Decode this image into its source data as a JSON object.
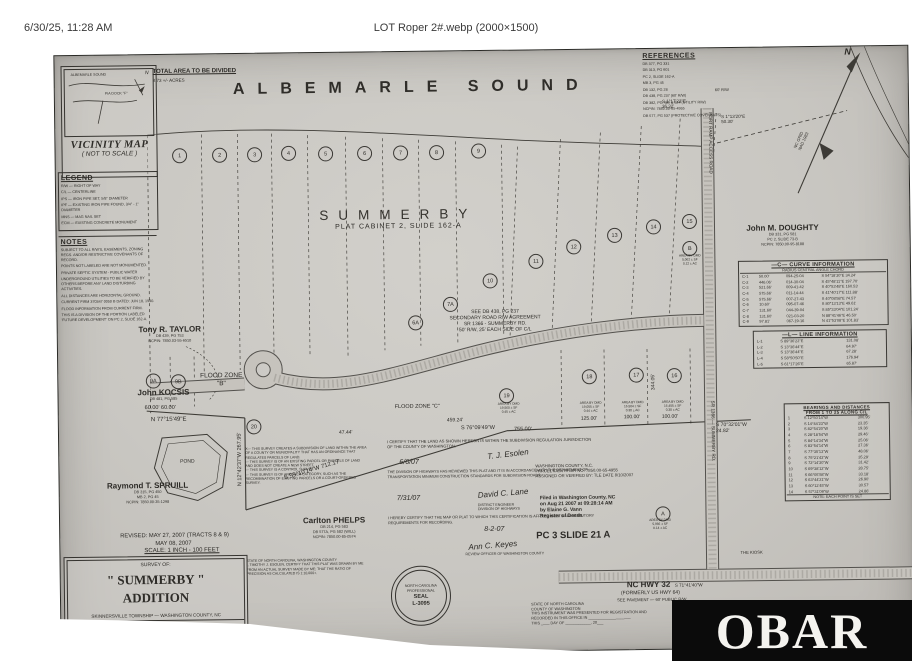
{
  "header": {
    "datetime": "6/30/25, 11:28 AM",
    "filename": "LOT Roper 2#.webp (2000×1500)"
  },
  "watermark": {
    "text": "OBAR",
    "bg": "#0b0b0b",
    "fg": "#f4f3ef"
  },
  "plat": {
    "sound_title": "ALBEMARLE  SOUND",
    "summerby": "SUMMERBY",
    "plat_ref": "PLAT CABINET 2, SLIDE 162-A",
    "total_area": {
      "title": "TOTAL AREA TO BE DIVIDED",
      "value": "8.73 +/- ACRES"
    },
    "vicinity": {
      "title": "VICINITY MAP",
      "sub": "( NOT TO SCALE )",
      "inset_sound": "ALBEMARLE SOUND",
      "inset_road": "PIA DOCK \"F\"",
      "inset_n": "N"
    },
    "legend": {
      "title": "LEGEND",
      "items": [
        "R/W — RIGHT OF WAY",
        "C/L — CENTERLINE",
        "IPS — IRON PIPE SET, 5/8\" DIAMETER",
        "IPF — EXISTING IRON PIPE FOUND, 3/4\" - 1\" DIAMETER",
        "MNS — MAG NAIL SET",
        "ECM — EXISTING CONCRETE MONUMENT"
      ]
    },
    "notes": {
      "title": "NOTES",
      "items": [
        "SUBJECT TO ALL R/W'S, EASEMENTS, ZONING REGS. AND/OR RESTRICTIVE COVENANTS OF RECORD.",
        "POINTS NOT LABELED ARE NOT MONUMENTED.",
        "PRIVATE SEPTIC SYSTEM - PUBLIC WATER",
        "UNDERGROUND UTILITIES TO BE VERIFIED BY OTHERS BEFORE ANY LAND DISTURBING ACTIVITIES.",
        "ALL DISTANCES ARE HORIZONTAL GROUND.",
        "CURRENT FIRM 370347 0050 B DATED: JUN 18, 1990.",
        "FLOOD INFORMATION FROM CURRENT FIRM.",
        "THIS IS A DIVISION OF THE PORTION LABELED 'FUTURE DEVELOPMENT' ON PC 2, SLIDE 162-A."
      ]
    },
    "references": {
      "title": "REFERENCES",
      "items": [
        "DB 377, PG 331",
        "DB 313, PG 601",
        "PC 2, SLIDE 162-A",
        "MB 3, PG 45",
        "DB 132, PG 28",
        "DB 438, PG 237 (60' R/W)",
        "DB 382, PG 489 & 624 (UTILITY R/W)",
        "NCPIN: 7850.00-65-4955",
        "DB 577, PG 537 (PROTECTIVE COVENANTS)"
      ]
    },
    "owners": [
      {
        "name": "Tony R. TAYLOR",
        "details": "DB 439, PG 753\nNCPIN: 7850.03-55-6510",
        "x": 62,
        "y": 270,
        "w": 100
      },
      {
        "name": "John KOCSIS",
        "details": "DB 481, PG 585",
        "x": 55,
        "y": 333,
        "w": 100
      },
      {
        "name": "Raymond T. SPRUILL",
        "details": "DB 315, PG 450\nMB 2, PG 45\nNCPIN: 7850.00-35-1298",
        "x": 38,
        "y": 426,
        "w": 100
      },
      {
        "name": "Carlton PHELPS",
        "details": "DB 214, PG 583\nDB 577A, PG 582 (WILL)\nNCPIN: 7850.00-85-0574",
        "x": 224,
        "y": 463,
        "w": 100
      },
      {
        "name": "John M. DOUGHTY",
        "details": "DB 331, PG 581\nPC 2, SLIDE 73-B\nNCPIN: 7850.00-95-8188",
        "x": 676,
        "y": 176,
        "w": 100
      }
    ],
    "lots": [
      {
        "n": "1",
        "x": 124,
        "y": 101
      },
      {
        "n": "2",
        "x": 164,
        "y": 101
      },
      {
        "n": "3",
        "x": 199,
        "y": 101
      },
      {
        "n": "4",
        "x": 233,
        "y": 100
      },
      {
        "n": "5",
        "x": 270,
        "y": 101
      },
      {
        "n": "6",
        "x": 309,
        "y": 101
      },
      {
        "n": "7",
        "x": 345,
        "y": 101
      },
      {
        "n": "8",
        "x": 381,
        "y": 101
      },
      {
        "n": "9",
        "x": 423,
        "y": 100
      },
      {
        "n": "10",
        "x": 433,
        "y": 230
      },
      {
        "n": "11",
        "x": 479,
        "y": 211
      },
      {
        "n": "12",
        "x": 517,
        "y": 197
      },
      {
        "n": "13",
        "x": 558,
        "y": 186
      },
      {
        "n": "14",
        "x": 597,
        "y": 178
      },
      {
        "n": "15",
        "x": 633,
        "y": 173
      },
      {
        "n": "B",
        "x": 633,
        "y": 200
      },
      {
        "n": "7A",
        "x": 393,
        "y": 253
      },
      {
        "n": "6A",
        "x": 358,
        "y": 271
      },
      {
        "n": "9A",
        "x": 95,
        "y": 326
      },
      {
        "n": "9B",
        "x": 120,
        "y": 327
      },
      {
        "n": "20",
        "x": 195,
        "y": 373
      },
      {
        "n": "19",
        "x": 448,
        "y": 345
      },
      {
        "n": "18",
        "x": 531,
        "y": 327
      },
      {
        "n": "17",
        "x": 578,
        "y": 326
      },
      {
        "n": "16",
        "x": 616,
        "y": 327
      },
      {
        "n": "A",
        "x": 603,
        "y": 465
      }
    ],
    "curve_table": {
      "title": "—C— CURVE INFORMATION",
      "colhead": "RADIUS      CENTRAL ANGLE      CHORD",
      "rows": [
        {
          "id": "C-1",
          "r": "50.00'",
          "a": "094-25-04",
          "c": "S 54°18'30\"E  34.24'"
        },
        {
          "id": "C-2",
          "r": "446.06'",
          "a": "014-30-04",
          "c": "S 45°48'11\"E  197.70'"
        },
        {
          "id": "C-3",
          "r": "521.66'",
          "a": "009-41-42",
          "c": "S 40°53'48\"E  160.53'"
        },
        {
          "id": "C-4",
          "r": "575.66'",
          "a": "011-14-44",
          "c": "S 41°40'17\"E  111.88'"
        },
        {
          "id": "C-5",
          "r": "575.66'",
          "a": "007-27-43",
          "c": "S 40°08'58\"E  74.57'"
        },
        {
          "id": "C-6",
          "r": "10.60'",
          "a": "095-07-46",
          "c": "S 80°13'13\"E  49.61'"
        },
        {
          "id": "C-7",
          "r": "131.60'",
          "a": "044-39-04",
          "c": "S 85°33'04\"E  101.24'"
        },
        {
          "id": "C-8",
          "r": "131.60'",
          "a": "021-03-20",
          "c": "N 88°41'46\"E  46.50'"
        },
        {
          "id": "C-9",
          "r": "97.81'",
          "a": "067-19-16",
          "c": "N 41°53'08\"E  101.83'"
        }
      ]
    },
    "line_table": {
      "title": "—L— LINE INFORMATION",
      "rows": [
        {
          "id": "L-1",
          "b": "S 89°36'22\"E",
          "d": "131.08'"
        },
        {
          "id": "L-2",
          "b": "S 13°36'44\"E",
          "d": "64.97'"
        },
        {
          "id": "L-3",
          "b": "S 13°36'44\"E",
          "d": "67.28'"
        },
        {
          "id": "L-4",
          "b": "S 58°50'50\"E",
          "d": "176.94'"
        },
        {
          "id": "L-5",
          "b": "S 61°17'26\"E",
          "d": "65.87'"
        }
      ]
    },
    "cl_table": {
      "title": "BEARINGS AND DISTANCES\nFROM 1 TO 25 ALONG C/L",
      "note": "NOTE: EACH POINT IS SET",
      "rows": [
        {
          "id": "1",
          "b": "S 12°50'14\"W",
          "d": "300.95'"
        },
        {
          "id": "2",
          "b": "S 14°44'23\"W",
          "d": "23.35'"
        },
        {
          "id": "3",
          "b": "S 82°54'20\"W",
          "d": "19.36'"
        },
        {
          "id": "4",
          "b": "S 28°18'54\"W",
          "d": "29.46'"
        },
        {
          "id": "5",
          "b": "S 84°14'34\"W",
          "d": "25.06'"
        },
        {
          "id": "6",
          "b": "S 83°54'14\"W",
          "d": "27.36'"
        },
        {
          "id": "7",
          "b": "S 77°35'13\"W",
          "d": "48.06'"
        },
        {
          "id": "8",
          "b": "S 75°21'43\"W",
          "d": "35.29'"
        },
        {
          "id": "9",
          "b": "S 72°14'30\"W",
          "d": "31.42'"
        },
        {
          "id": "10",
          "b": "S 69°38'12\"W",
          "d": "28.75'"
        },
        {
          "id": "11",
          "b": "S 66°05'58\"W",
          "d": "33.18'"
        },
        {
          "id": "12",
          "b": "S 63°44'21\"W",
          "d": "26.90'"
        },
        {
          "id": "13",
          "b": "S 60°12'45\"W",
          "d": "30.57'"
        },
        {
          "id": "14",
          "b": "S 57°31'09\"W",
          "d": "24.86'"
        }
      ]
    },
    "title_block": {
      "survey_of": "SURVEY OF:",
      "name": "\" SUMMERBY \"",
      "name2": "ADDITION",
      "township": "SKINNERSVILLE TOWNSHIP — WASHINGTON COUNTY, NC",
      "surveyor": "TIMOTHY J. ESOLEN",
      "license": "PROFESSIONAL LAND SURVEYOR L-3095"
    },
    "seal": {
      "l1": "NORTH CAROLINA",
      "l2": "PROFESSIONAL",
      "l3": "SEAL",
      "l4": "L-3095"
    },
    "annotations": [
      {
        "t": "60.00'   60.00'",
        "x": 86,
        "y": 350,
        "s": 5.5
      },
      {
        "t": "N 77°15'49\"E",
        "x": 92,
        "y": 362,
        "s": 6
      },
      {
        "t": "N 12°42'37\"W   267.95'",
        "x": 136,
        "y": 402,
        "s": 5.5,
        "rot": -90,
        "w": 90,
        "align": "center"
      },
      {
        "t": "S 55°10'14\"W      712.17'",
        "x": 188,
        "y": 414,
        "s": 6,
        "rot": -16,
        "w": 130,
        "align": "center"
      },
      {
        "t": "S 76°09'49\"W",
        "x": 402,
        "y": 374,
        "s": 5.5
      },
      {
        "t": "755.00'",
        "x": 455,
        "y": 376,
        "s": 5.5
      },
      {
        "t": "459.24'",
        "x": 388,
        "y": 366,
        "s": 5
      },
      {
        "t": "47.44'",
        "x": 280,
        "y": 377,
        "s": 5
      },
      {
        "t": "125.00'",
        "x": 522,
        "y": 366,
        "s": 5
      },
      {
        "t": "100.00'",
        "x": 565,
        "y": 365,
        "s": 5
      },
      {
        "t": "100.00'",
        "x": 603,
        "y": 365,
        "s": 5
      },
      {
        "t": "S 70°32'01\"W\n24.82'",
        "x": 657,
        "y": 374,
        "s": 5
      },
      {
        "t": "S 1°17'23\"E\n36.32'",
        "x": 607,
        "y": 50,
        "s": 4.5
      },
      {
        "t": "S 1°13'20\"E\n50.30'",
        "x": 666,
        "y": 66,
        "s": 4.5
      },
      {
        "t": "344.05'",
        "x": 563,
        "y": 330,
        "s": 5,
        "rot": -90,
        "w": 64,
        "align": "center"
      },
      {
        "t": "FLOOD ZONE\n\"B\"",
        "x": 132,
        "y": 318,
        "s": 6.5,
        "w": 62,
        "align": "center"
      },
      {
        "t": "FLOOD ZONE \"C\"",
        "x": 336,
        "y": 352,
        "s": 5.5
      },
      {
        "t": "POND",
        "x": 108,
        "y": 404,
        "s": 5,
        "w": 40,
        "align": "center"
      },
      {
        "t": "NC GRID\nNAD 1983",
        "x": 736,
        "y": 88,
        "s": 4.2,
        "rot": -65
      },
      {
        "t": "60' R/W",
        "x": 660,
        "y": 40,
        "s": 4
      },
      {
        "t": "THE KIOSK",
        "x": 680,
        "y": 502,
        "s": 4.2
      },
      {
        "t": "S 71°41'40\"W",
        "x": 614,
        "y": 534,
        "s": 4.5
      },
      {
        "t": "NC HWY 32",
        "x": 566,
        "y": 531,
        "s": 8,
        "bold": true,
        "name": "nc-hwy-32-label"
      },
      {
        "t": "(FORMERLY US HWY 64)",
        "x": 560,
        "y": 541,
        "s": 5
      },
      {
        "t": "SEE PAVEMENT — 60' PUBLIC R/W",
        "x": 556,
        "y": 548,
        "s": 4.2
      },
      {
        "t": "REVISED:  MAY 27, 2007 (TRACTS 8 & 9)",
        "x": 60,
        "y": 478,
        "s": 5.8,
        "name": "revised-date"
      },
      {
        "t": "MAY 08, 2007",
        "x": 95,
        "y": 486,
        "s": 5.8,
        "name": "survey-date"
      },
      {
        "t": "SCALE:  1 INCH - 100 FEET",
        "x": 84,
        "y": 493,
        "s": 6,
        "u": true,
        "name": "scale-label"
      },
      {
        "t": "N",
        "x": 790,
        "y": 0,
        "s": 9,
        "bold": true,
        "italic": true,
        "name": "north-label"
      },
      {
        "t": "6/6/07",
        "x": 340,
        "y": 407,
        "s": 7,
        "italic": true
      },
      {
        "t": "7/31/07",
        "x": 337,
        "y": 443,
        "s": 7,
        "italic": true
      },
      {
        "t": "8-2-07",
        "x": 424,
        "y": 475,
        "s": 7,
        "italic": true
      },
      {
        "t": "T. J. Esolen",
        "x": 428,
        "y": 399,
        "s": 8,
        "italic": true,
        "rot": -6,
        "name": "signature"
      },
      {
        "t": "David C. Lane",
        "x": 418,
        "y": 438,
        "s": 8,
        "italic": true,
        "rot": -4,
        "name": "signature"
      },
      {
        "t": "Ann C. Keyes",
        "x": 408,
        "y": 490,
        "s": 8,
        "italic": true,
        "rot": -4,
        "name": "signature"
      },
      {
        "t": "DISTRICT ENGINEER\nDIVISION OF HIGHWAYS",
        "x": 418,
        "y": 452,
        "s": 3.6
      },
      {
        "t": "REVIEW OFFICER OF WASHINGTON COUNTY",
        "x": 405,
        "y": 501,
        "s": 3.6
      },
      {
        "t": "I CERTIFY THAT THE LAND AS SHOWN HEREON IS WITHIN THE SUBDIVISION REGULATION JURISDICTION OF THE COUNTY OF WASHINGTON.",
        "x": 328,
        "y": 388,
        "s": 4,
        "w": 205
      },
      {
        "t": "THE DIVISION OF HIGHWAYS HAS REVIEWED THIS PLAT AND IT IS IN ACCORDANCE WITH THE DEPARTMENT OF TRANSPORTATION MINIMUM CONSTRUCTION STANDARDS FOR SUBDIVISION ROADS.",
        "x": 328,
        "y": 418,
        "s": 3.7,
        "w": 210
      },
      {
        "t": "I HEREBY CERTIFY THAT THE MAP OR PLAT TO WHICH THIS CERTIFICATION IS AFFIXED MEETS ALL STATUTORY REQUIREMENTS FOR RECORDING.",
        "x": 328,
        "y": 464,
        "s": 3.8,
        "w": 210
      },
      {
        "t": "X— THIS SURVEY CREATES A SUBDIVISION OF LAND WITHIN THE AREA OF A COUNTY OR MUNICIPALITY THAT HAS AN ORDINANCE THAT REGULATES PARCELS OF LAND.\n— THIS SURVEY IS OF AN EXISTING PARCEL OR PARCELS OF LAND AND DOES NOT CREATE A NEW STREET.\n— THIS SURVEY IS A CONTROL SURVEY.\n— THIS SURVEY IS OF ANOTHER CATEGORY, SUCH AS THE RECOMBINATION OF EXISTING PARCELS OR A COURT-ORDERED SURVEY.",
        "x": 186,
        "y": 393,
        "s": 3.5,
        "w": 122
      },
      {
        "t": "STATE OF NORTH CAROLINA, WASHINGTON COUNTY\nI, TIMOTHY J. ESOLEN, CERTIFY THAT THIS PLAT WAS DRAWN BY ME FROM AN ACTUAL SURVEY MADE BY ME; THAT THE RATIO OF PRECISION AS CALCULATED IS 1:10,000+.",
        "x": 186,
        "y": 505,
        "s": 3.5,
        "w": 122
      },
      {
        "t": "SEE DB 438, PG 237\nSECONDARY ROAD R/W AGREEMENT\nSR 1366 - SUMMERBY RD.\n50' R/W, 25' EACH SIDE OF C/L",
        "x": 340,
        "y": 258,
        "s": 5,
        "w": 195,
        "align": "center",
        "name": "road-agreement-note"
      },
      {
        "t": "PORT RAMP ACCESS ROAD",
        "x": 600,
        "y": 92,
        "s": 4.6,
        "rot": 90,
        "w": 110,
        "align": "center",
        "name": "port-ramp-road-label"
      },
      {
        "t": "SR 1366 — SUMMERBY RD.",
        "x": 598,
        "y": 380,
        "s": 4.6,
        "rot": 90,
        "w": 112,
        "align": "center",
        "name": "summerby-road-label"
      },
      {
        "t": "WASHINGTON COUNTY, N.C.\nPARCEL IDENTIFIER NO.  7850.00-65-4955\nASSIGNED OR VERIFIED BY:  TLE     DATE 8/10/2007",
        "x": 476,
        "y": 413,
        "s": 4.2,
        "name": "parcel-identifier-block"
      },
      {
        "t": "Filed in Washington County, NC\non Aug 21 2007 at 09:28:14 AM\nby   Elaine G. Vann\n      Register of Deeds",
        "x": 480,
        "y": 445,
        "s": 5,
        "bold": true,
        "name": "filed-stamp"
      },
      {
        "t": "PC 3 SLIDE 21 A",
        "x": 476,
        "y": 480,
        "s": 9.5,
        "bold": true,
        "name": "pc-slide-label"
      },
      {
        "t": "STATE OF NORTH CAROLINA\nCOUNTY OF  WASHINGTON\nTHIS INSTRUMENT WAS PRESENTED FOR REGISTRATION AND\nRECORDED IN THIS OFFICE IN ____________________\nTHIS ____ DAY OF ____________, 20___",
        "x": 470,
        "y": 552,
        "s": 3.8,
        "name": "registration-block"
      },
      {
        "t": "AREA BY DMD\n19,560 ± SF\n0.45 ± AC",
        "x": 428,
        "y": 352,
        "s": 3.2,
        "w": 44,
        "align": "center"
      },
      {
        "t": "AREA BY DMD\n19,055 ± SF\n0.44 ± AC",
        "x": 510,
        "y": 352,
        "s": 3.2,
        "w": 44,
        "align": "center"
      },
      {
        "t": "AREA BY DMD\n16,504 ± SF\n0.38 ± AC",
        "x": 552,
        "y": 352,
        "s": 3.2,
        "w": 44,
        "align": "center"
      },
      {
        "t": "AREA BY DMD\n16,455 ± SF\n0.38 ± AC",
        "x": 592,
        "y": 352,
        "s": 3.2,
        "w": 44,
        "align": "center"
      },
      {
        "t": "AREA BY DMD\n5,062 ± SF\n0.12 ± AC",
        "x": 613,
        "y": 206,
        "s": 3.2,
        "w": 40,
        "align": "center"
      },
      {
        "t": "AREA BY DMD\n5,966 ± SF\n0.14 ± AC",
        "x": 578,
        "y": 470,
        "s": 3.2,
        "w": 44,
        "align": "center"
      }
    ]
  }
}
